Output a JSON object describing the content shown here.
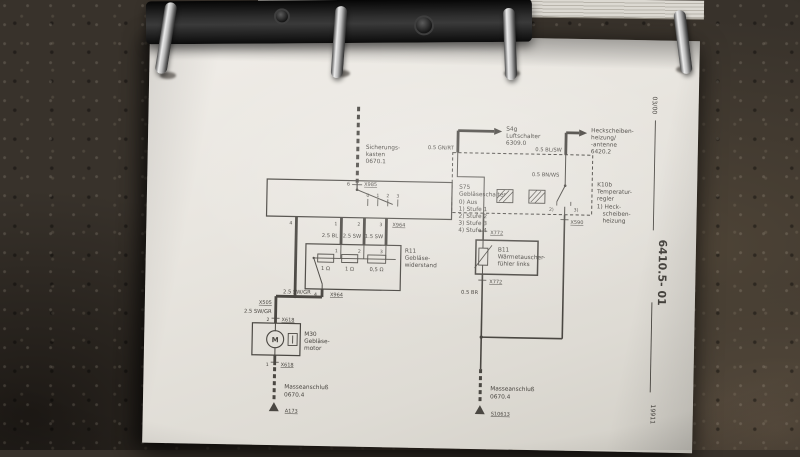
{
  "colors": {
    "stone": "#38322b",
    "page": "#e9e6e0",
    "ink": "#47443f",
    "binder_metal": "#1a1a1a",
    "ring_chrome": "#cccccc"
  },
  "margin": {
    "top_code": "03/00",
    "doc_number": "6410.5- 01",
    "bottom_code": "19911"
  },
  "left_circuit": {
    "fuse_label": [
      "Sicherungs-",
      "kasten",
      "0670.1"
    ],
    "fuse_pin": "6",
    "fuse_connector": "X985",
    "switch_legend": [
      "S75",
      "Gebläseschalter",
      "0)  Aus",
      "1)  Stufe 1",
      "2)  Stufe 2",
      "3)  Stufe 3",
      "4)  Stufe 4"
    ],
    "contact_numbers": [
      "0",
      "1",
      "2",
      "3"
    ],
    "bottom_pin_numbers": [
      "4",
      "1",
      "2",
      "3"
    ],
    "connector_out": "X964",
    "wire_labels": {
      "w1": "2.5 BL",
      "w2": "2.5 SW",
      "w3": "1.5 SW",
      "w4": "2.5 SW/GR",
      "w5": "2.5 SW/GR"
    },
    "resistor": {
      "pins_top": [
        "1",
        "2",
        "3"
      ],
      "label": [
        "R11",
        "Gebläse-",
        "widerstand"
      ],
      "values": [
        "1 Ω",
        "1 Ω",
        "0,5 Ω"
      ],
      "pin_bottom": "4",
      "connector_bottom": "X964"
    },
    "connector_mid": "X505",
    "motor": {
      "pin_top": "2",
      "connector_top": "X618",
      "symbol": "M",
      "label": [
        "M30",
        "Gebläse-",
        "motor"
      ],
      "pin_bottom": "1",
      "connector_bottom": "X618"
    },
    "ground": {
      "label": [
        "Masseanschluß",
        "0670.4"
      ],
      "point": "A173"
    }
  },
  "right_circuit": {
    "air_switch": {
      "label": [
        "S4g",
        "Luftschalter",
        "6309.0"
      ],
      "wire": "0.5 GN/RT"
    },
    "rear_window": {
      "label": [
        "Heckscheiben-",
        "heizung/",
        "-antenne",
        "6420.2"
      ],
      "wire": "0.5 BL/SW"
    },
    "regulator": {
      "label": [
        "K10b",
        "Temperatur-",
        "regler",
        "1) Heck-",
        "scheiben-",
        "heizung"
      ],
      "inner_wire": "0.5 BN/WS",
      "contact_2": "2)",
      "contact_3": "3)",
      "connector_out": "X590"
    },
    "sensor": {
      "connector_top": "X772",
      "label": [
        "B11",
        "Wärmetauscher-",
        "fühler links"
      ],
      "connector_bottom": "X772",
      "wire": "0.5 BR"
    },
    "ground": {
      "label": [
        "Masseanschluß",
        "0670.4"
      ],
      "point": "S10613"
    }
  }
}
